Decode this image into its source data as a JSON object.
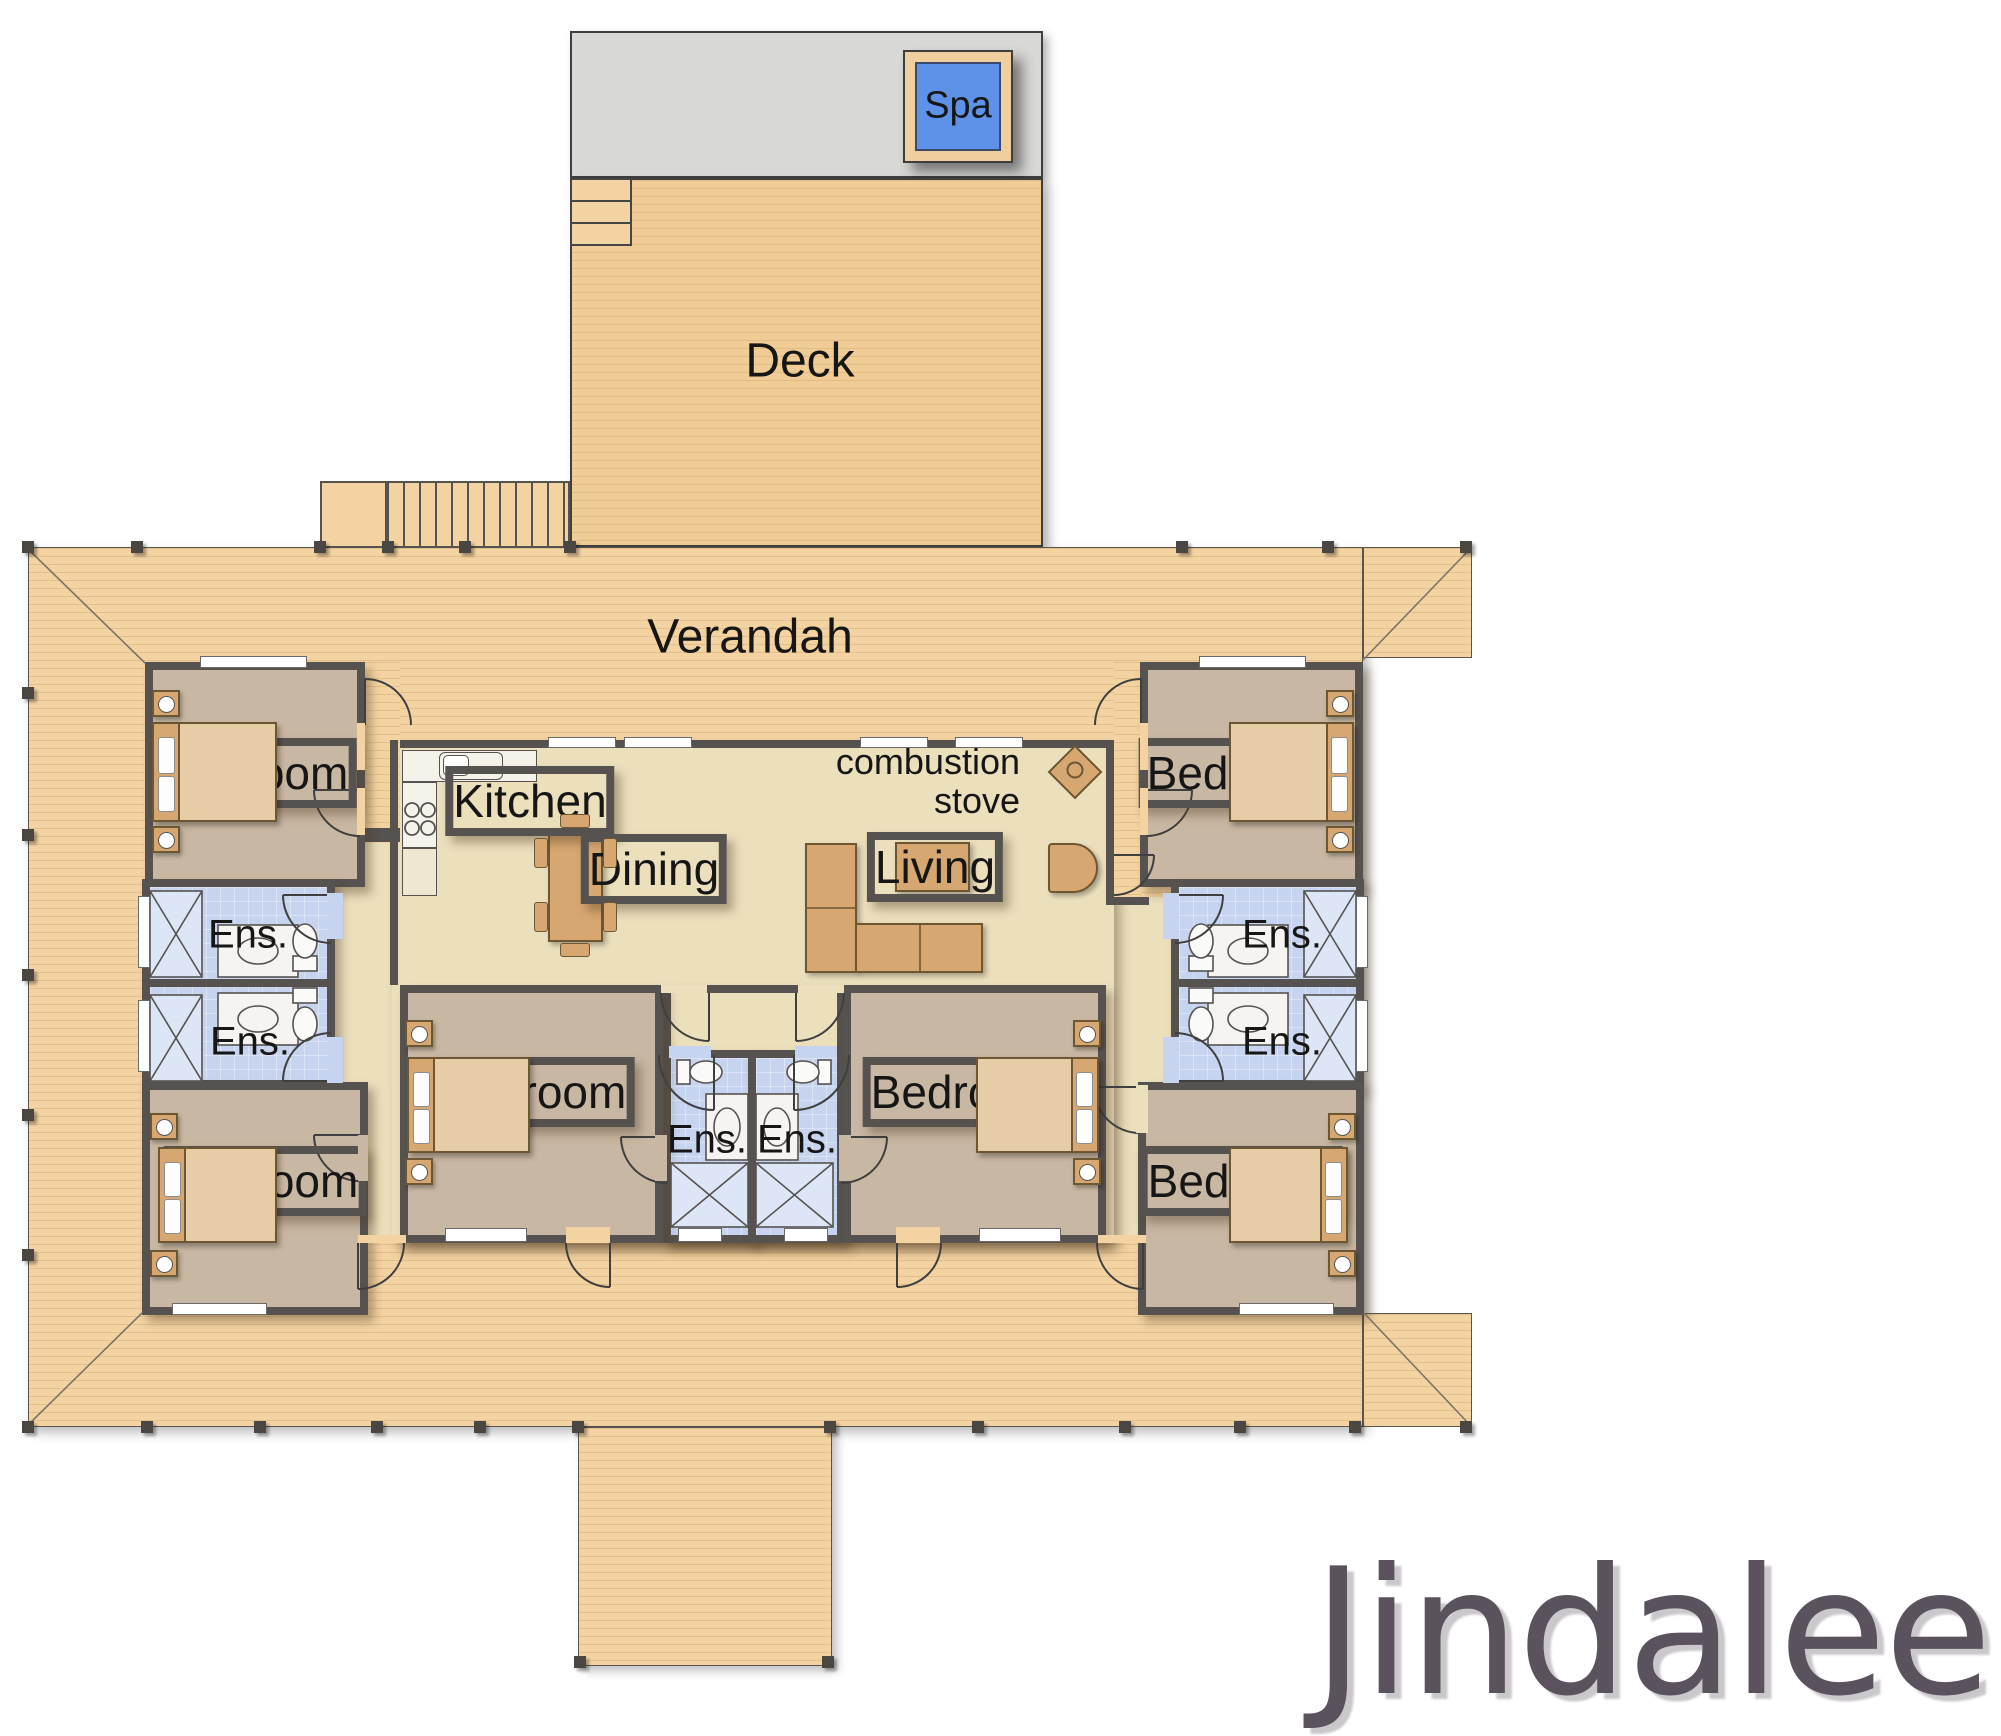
{
  "title": {
    "text": "Jindalee"
  },
  "areas": {
    "deck": "Deck",
    "verandah": "Verandah",
    "spa": "Spa",
    "kitchen": "Kitchen",
    "dining": "Dining",
    "living": "Living",
    "stove_line1": "combustion",
    "stove_line2": "stove"
  },
  "rooms": {
    "bedrooms": [
      {
        "label": "Bedroom"
      },
      {
        "label": "Bedroom"
      },
      {
        "label": "Bedroom"
      },
      {
        "label": "Bedroom"
      },
      {
        "label": "Bedroom"
      },
      {
        "label": "Bedroom"
      }
    ],
    "ensuites": [
      {
        "label": "Ens."
      },
      {
        "label": "Ens."
      },
      {
        "label": "Ens."
      },
      {
        "label": "Ens."
      },
      {
        "label": "Ens."
      },
      {
        "label": "Ens."
      }
    ]
  },
  "colors": {
    "wall": "#565250",
    "verandah": "#f3d3a2",
    "deck": "#f0cc96",
    "concrete": "#d8d8d5",
    "water": "#5e92e9",
    "floor_living": "#ebdfbc",
    "floor_bedroom": "#c8b7a2",
    "floor_wet": "#c6d4ef",
    "shower": "#dde6f7",
    "furniture": "#d7a771",
    "furniture_border": "#6d5632",
    "bed": "#e6cda6",
    "pillow": "#fdfdfd",
    "white_fix": "#f8f7f4",
    "title": "#5a525c",
    "label": "#161616"
  }
}
